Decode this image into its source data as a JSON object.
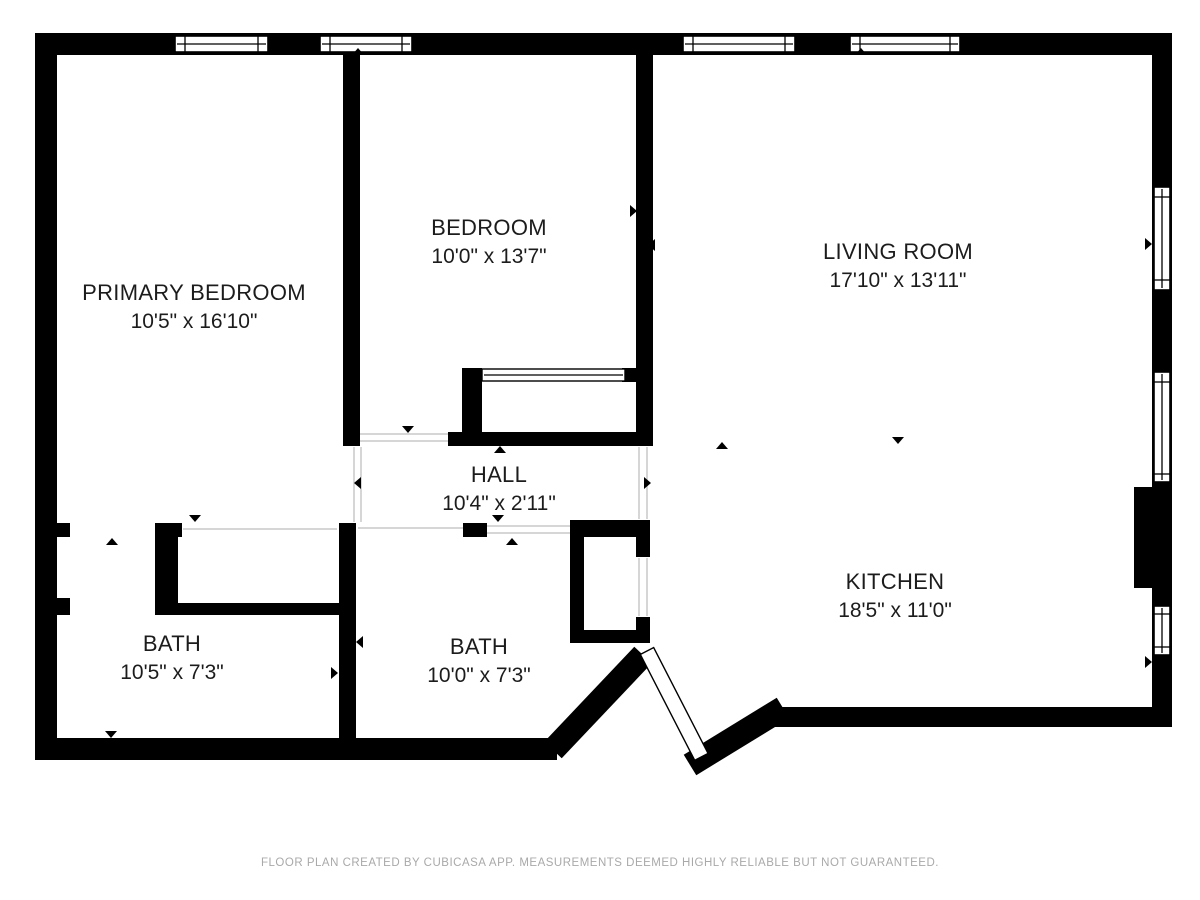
{
  "document": {
    "type": "floor-plan",
    "creator_note_visible": true
  },
  "rooms": [
    {
      "id": "primary-bedroom",
      "name": "PRIMARY BEDROOM",
      "dimensions": "10'5\" x 16'10\""
    },
    {
      "id": "bedroom",
      "name": "BEDROOM",
      "dimensions": "10'0\" x 13'7\""
    },
    {
      "id": "living-room",
      "name": "LIVING ROOM",
      "dimensions": "17'10\" x 13'11\""
    },
    {
      "id": "hall",
      "name": "HALL",
      "dimensions": "10'4\" x 2'11\""
    },
    {
      "id": "bath-left",
      "name": "BATH",
      "dimensions": "10'5\" x 7'3\""
    },
    {
      "id": "bath-right",
      "name": "BATH",
      "dimensions": "10'0\" x 7'3\""
    },
    {
      "id": "kitchen",
      "name": "KITCHEN",
      "dimensions": "18'5\" x 11'0\""
    }
  ],
  "footer": {
    "disclaimer": "FLOOR PLAN CREATED BY CUBICASA APP. MEASUREMENTS DEEMED HIGHLY RELIABLE BUT NOT GUARANTEED."
  },
  "icons": {
    "direction_marker": "small black triangle marking door/window orientation",
    "window": "white bar with frame lines inside wall",
    "door_leaf": "white angled band across entry opening"
  },
  "colors": {
    "wall": "#000000",
    "background": "#ffffff",
    "room_label": "#1c1c1c",
    "footer_text": "#a9a9a9",
    "opening_line": "#c9c9c9"
  }
}
